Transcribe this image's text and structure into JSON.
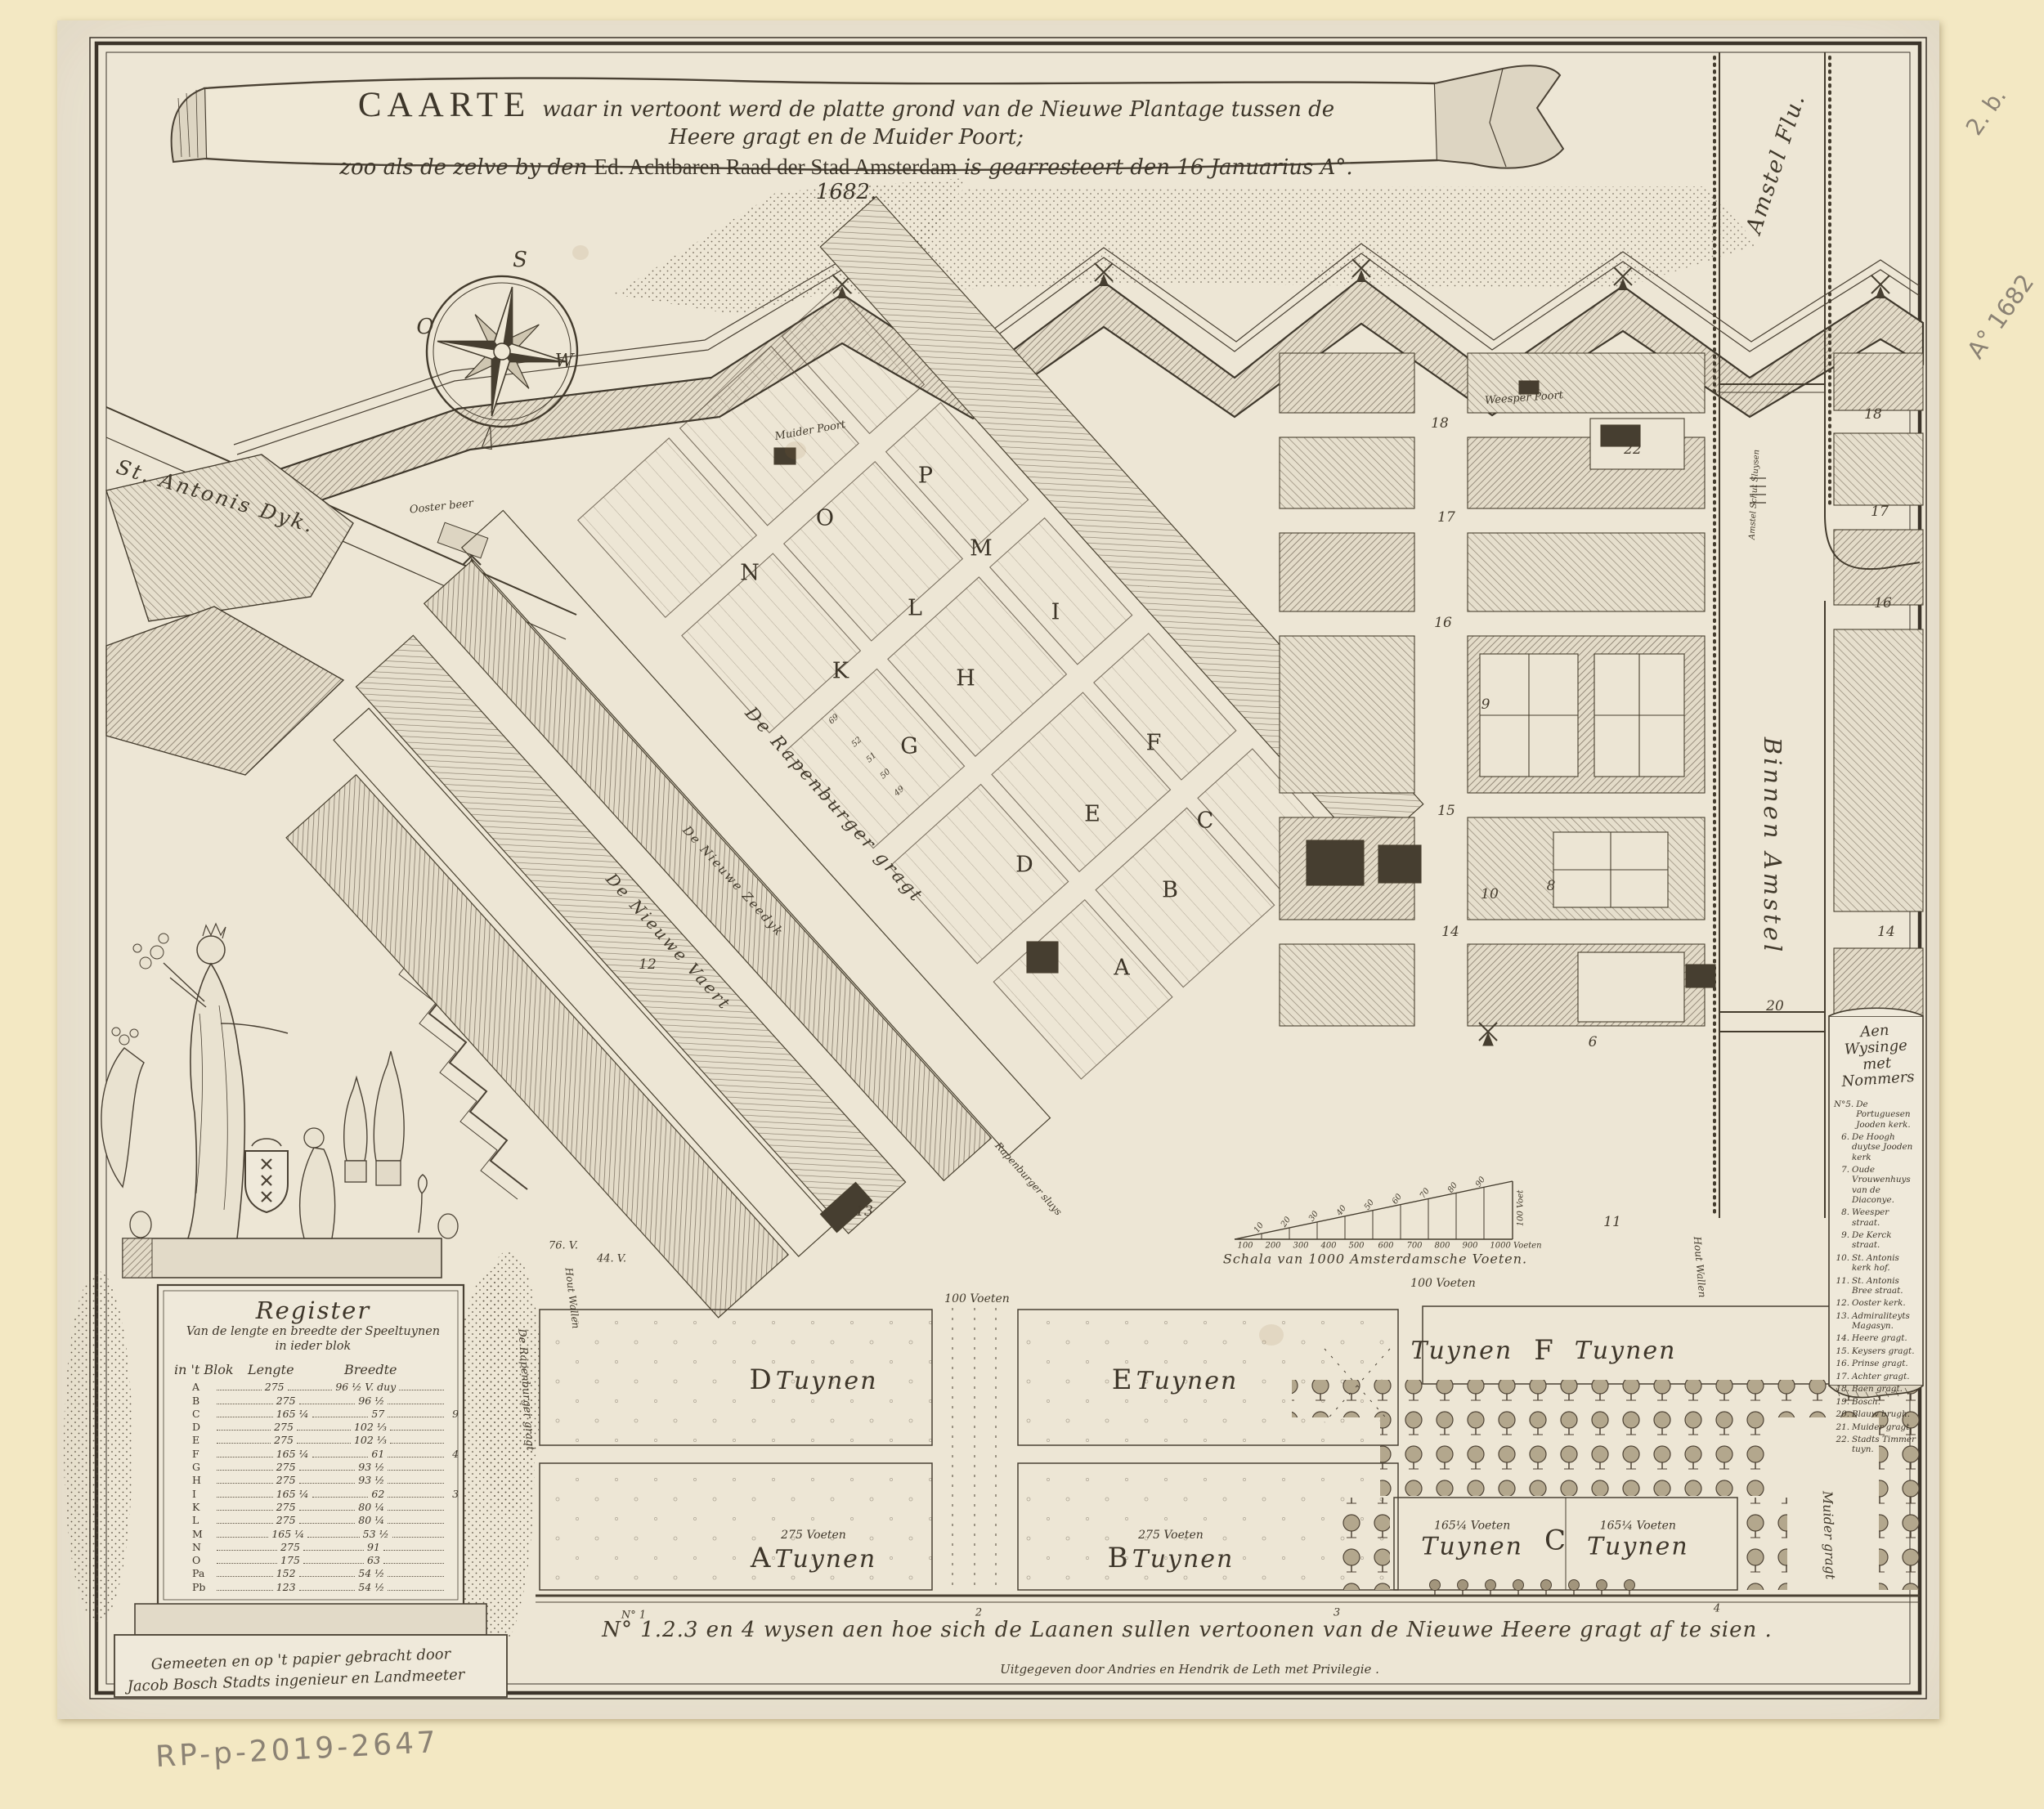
{
  "title": {
    "lead": "CAARTE",
    "line1": "waar in vertoont werd de platte grond van de Nieuwe Plantage tussen de Heere gragt en de Muider Poort;",
    "line2a": "zoo als de zelve by den",
    "line2b": "Ed. Achtbaren Raad der Stad Amsterdam",
    "line2c": "is gearresteert den 16 Januarius A°. 1682."
  },
  "compass": {
    "s": "S",
    "o": "O",
    "w": "W"
  },
  "streets": {
    "st_antonis_dyk": "St. Antonis Dyk.",
    "ooster_beer": "Ooster beer",
    "muider_poort": "Muider Poort",
    "weesper_poort": "Weesper Poort",
    "amstel_flu": "Amstel Flu.",
    "amstel_schut": "Amstel Schut Sluysen",
    "binnen_amstel": "Binnen Amstel",
    "muider_gragt": "Muider gragt",
    "rapenburger_gragt": "De Rapenburger gragt",
    "nieuwe_zeedyk": "De Nieuwe Zeedyk",
    "nieuwe_vaert": "De Nieuwe Vaert",
    "rapenburger_sluys": "Rapenburger sluys",
    "hout_wallen_1": "Hout Wallen",
    "hout_wallen_2": "Hout Wallen",
    "rapenburger_gragt_v": "De Rapenburger gragt"
  },
  "blocks": {
    "a": "A",
    "b": "B",
    "c": "C",
    "d": "D",
    "e": "E",
    "f": "F",
    "g": "G",
    "h": "H",
    "i": "I",
    "k": "K",
    "l": "L",
    "m": "M",
    "n": "N",
    "o": "O",
    "p": "P"
  },
  "plot_numbers": [
    "69",
    "52",
    "51",
    "50",
    "49"
  ],
  "numbers": {
    "n18a": "18",
    "n18b": "18",
    "n17a": "17",
    "n17b": "17",
    "n16a": "16",
    "n16b": "16",
    "n15": "15",
    "n14a": "14",
    "n14b": "14",
    "n13": "13",
    "n12": "12",
    "n11": "11",
    "n10": "10",
    "n9": "9",
    "n8": "8",
    "n6": "6",
    "n20": "20",
    "n22": "22"
  },
  "gardens": {
    "d": {
      "letter": "D",
      "word": "Tuynen"
    },
    "e": {
      "letter": "E",
      "word": "Tuynen"
    },
    "f": {
      "left": "Tuynen",
      "letter": "F",
      "right": "Tuynen"
    },
    "a": {
      "dim": "275 Voeten",
      "letter": "A",
      "word": "Tuynen"
    },
    "b": {
      "dim": "275 Voeten",
      "letter": "B",
      "word": "Tuynen"
    },
    "c": {
      "dim_left": "165¼ Voeten",
      "left": "Tuynen",
      "letter": "C",
      "dim_right": "165¼ Voeten",
      "right": "Tuynen"
    },
    "dim100a": "100 Voeten",
    "dim100b": "100 Voeten",
    "dim76": "76. V.",
    "dim44": "44. V.",
    "lane1": "N° 1",
    "lane2": "2",
    "lane3": "3",
    "lane4": "4"
  },
  "scalebar": {
    "caption": "Schala van 1000 Amsterdamsche Voeten.",
    "bottom_ticks": [
      "100",
      "200",
      "300",
      "400",
      "500",
      "600",
      "700",
      "800",
      "900",
      "1000 Voeten"
    ],
    "top_ticks": [
      "10",
      "20",
      "30",
      "40",
      "50",
      "60",
      "70",
      "80",
      "90"
    ],
    "right_label": "100 Voet"
  },
  "register": {
    "title": "Register",
    "subtitle1": "Van de lengte en breedte der Speeltuynen",
    "subtitle2": "in ieder blok",
    "col_block": "in 't Blok",
    "col_length": "Lengte",
    "col_breadth": "Breedte",
    "rows": [
      {
        "b": "A",
        "l": "275",
        "br": "96 ½ V. duy",
        "x": ""
      },
      {
        "b": "B",
        "l": "275",
        "br": "96 ½",
        "x": ""
      },
      {
        "b": "C",
        "l": "165 ¼",
        "br": "57",
        "x": "9"
      },
      {
        "b": "D",
        "l": "275",
        "br": "102 ⅓",
        "x": ""
      },
      {
        "b": "E",
        "l": "275",
        "br": "102 ⅓",
        "x": ""
      },
      {
        "b": "F",
        "l": "165 ¼",
        "br": "61",
        "x": "4"
      },
      {
        "b": "G",
        "l": "275",
        "br": "93 ½",
        "x": ""
      },
      {
        "b": "H",
        "l": "275",
        "br": "93 ½",
        "x": ""
      },
      {
        "b": "I",
        "l": "165 ¼",
        "br": "62",
        "x": "3"
      },
      {
        "b": "K",
        "l": "275",
        "br": "80 ¼",
        "x": ""
      },
      {
        "b": "L",
        "l": "275",
        "br": "80 ¼",
        "x": ""
      },
      {
        "b": "M",
        "l": "165 ¼",
        "br": "53 ½",
        "x": ""
      },
      {
        "b": "N",
        "l": "275",
        "br": "91",
        "x": ""
      },
      {
        "b": "O",
        "l": "175",
        "br": "63",
        "x": ""
      },
      {
        "b": "Pa",
        "l": "152",
        "br": "54 ½",
        "x": ""
      },
      {
        "b": "Pb",
        "l": "123",
        "br": "54 ½",
        "x": ""
      }
    ],
    "credit1": "Gemeeten en op 't papier gebracht door",
    "credit2": "Jacob Bosch Stadts ingenieur en Landmeeter"
  },
  "legend": {
    "title1": "Aen Wysinge",
    "title2": "met Nommers",
    "items": [
      {
        "num": "N°5.",
        "text": "De Portuguesen Jooden kerk."
      },
      {
        "num": "6.",
        "text": "De Hoogh duytse Jooden kerk"
      },
      {
        "num": "7.",
        "text": "Oude Vrouwenhuys van de Diaconye."
      },
      {
        "num": "8.",
        "text": "Weesper straat."
      },
      {
        "num": "9.",
        "text": "De Kerck straat."
      },
      {
        "num": "10.",
        "text": "St. Antonis kerk hof."
      },
      {
        "num": "11.",
        "text": "St. Antonis Bree straat."
      },
      {
        "num": "12.",
        "text": "Ooster kerk."
      },
      {
        "num": "13.",
        "text": "Admiraliteyts Magasyn."
      },
      {
        "num": "14.",
        "text": "Heere gragt."
      },
      {
        "num": "15.",
        "text": "Keysers gragt."
      },
      {
        "num": "16.",
        "text": "Prinse gragt."
      },
      {
        "num": "17.",
        "text": "Achter gragt."
      },
      {
        "num": "18.",
        "text": "Baen gragt."
      },
      {
        "num": "19.",
        "text": "Bosch."
      },
      {
        "num": "20.",
        "text": "Blauw brugh."
      },
      {
        "num": "21.",
        "text": "Muider gragt."
      },
      {
        "num": "22.",
        "text": "Stadts Timmer tuyn."
      }
    ]
  },
  "footer": {
    "caption": "N° 1.2.3 en 4 wysen aen hoe sich de Laanen sullen vertoonen van de Nieuwe Heere gragt af te sien .",
    "publisher": "Uitgegeven door Andries en Hendrik de Leth met Privilegie ."
  },
  "annotations": {
    "mark": "2. b.",
    "year": "A° 1682",
    "inventory": "RP-p-2019-2647"
  },
  "colors": {
    "ink": "#423a2c",
    "paper": "#ece5d4",
    "margin": "#f3e8c3",
    "pencil": "#8b8274",
    "hatch": "#7d7263"
  }
}
